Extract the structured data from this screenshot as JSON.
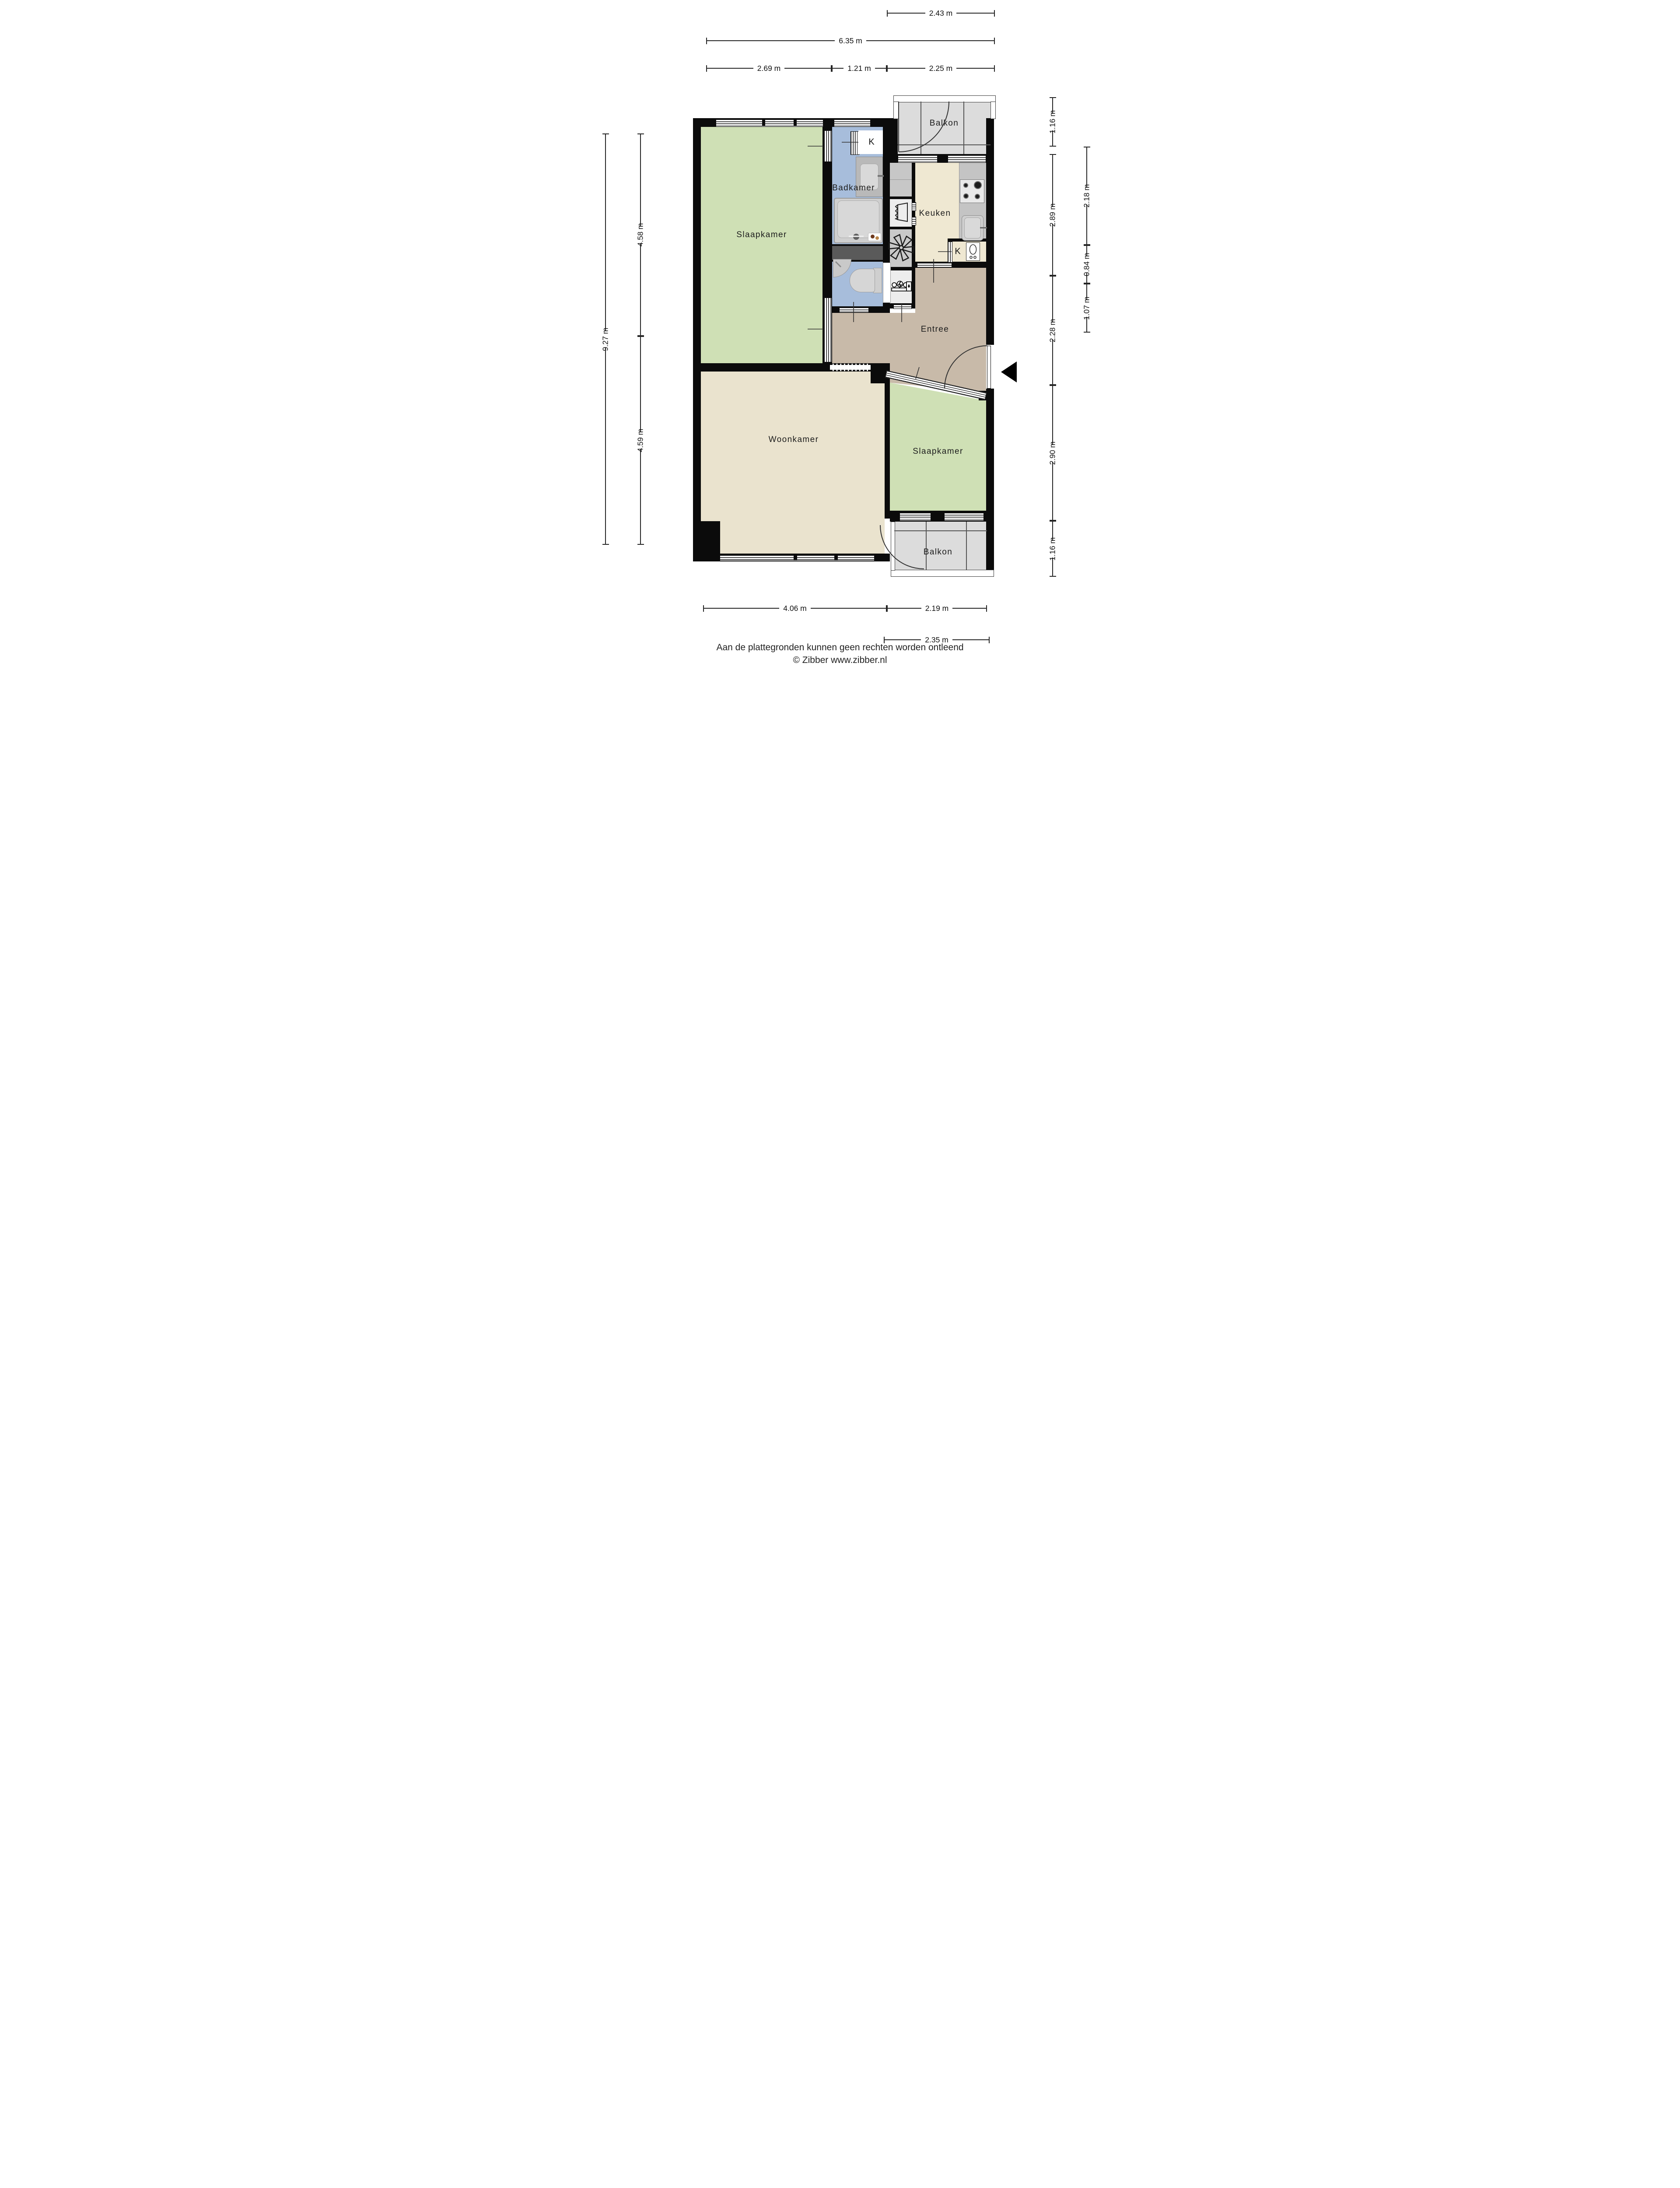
{
  "rooms": {
    "slaapkamer_left": {
      "label": "Slaapkamer",
      "color": "#cfe0b5"
    },
    "badkamer": {
      "label": "Badkamer",
      "color": "#a7bddb"
    },
    "wc": {
      "color": "#a7bddb"
    },
    "keuken": {
      "label": "Keuken",
      "color": "#efe8d2"
    },
    "entree": {
      "label": "Entree",
      "color": "#c8baa9"
    },
    "woonkamer": {
      "label": "Woonkamer",
      "color": "#eae3ce"
    },
    "slaapkamer_right": {
      "label": "Slaapkamer",
      "color": "#cfe0b5"
    },
    "balkon_top": {
      "label": "Balkon",
      "color": "#dcdcdc"
    },
    "balkon_bottom": {
      "label": "Balkon",
      "color": "#dcdcdc"
    }
  },
  "closets": {
    "badkamer_k": "K",
    "keuken_k": "K"
  },
  "dimensions": {
    "top": {
      "w243": "2.43 m",
      "w635": "6.35 m",
      "w269": "2.69 m",
      "w121": "1.21 m",
      "w225": "2.25 m"
    },
    "left": {
      "h927": "9.27 m",
      "h458": "4.58 m",
      "h459": "4.59 m"
    },
    "right": {
      "h116t": "1.16 m",
      "h218": "2.18 m",
      "h289": "2.89 m",
      "h084": "0.84 m",
      "h107": "1.07 m",
      "h228": "2.28 m",
      "h290": "2.90 m",
      "h116b": "1.16 m"
    },
    "bottom": {
      "w406": "4.06 m",
      "w219": "2.19 m",
      "w235": "2.35 m"
    }
  },
  "footer": {
    "disclaimer": "Aan de plattegronden kunnen geen rechten worden ontleend",
    "copyright": "© Zibber www.zibber.nl"
  },
  "palette": {
    "wall": "#0b0b0b",
    "dimension_line": "#252525",
    "balcony_line": "#555555",
    "counter": "#c4c4c4",
    "fixture": "#d6d6d6",
    "shaft": "#5a5a5a"
  }
}
